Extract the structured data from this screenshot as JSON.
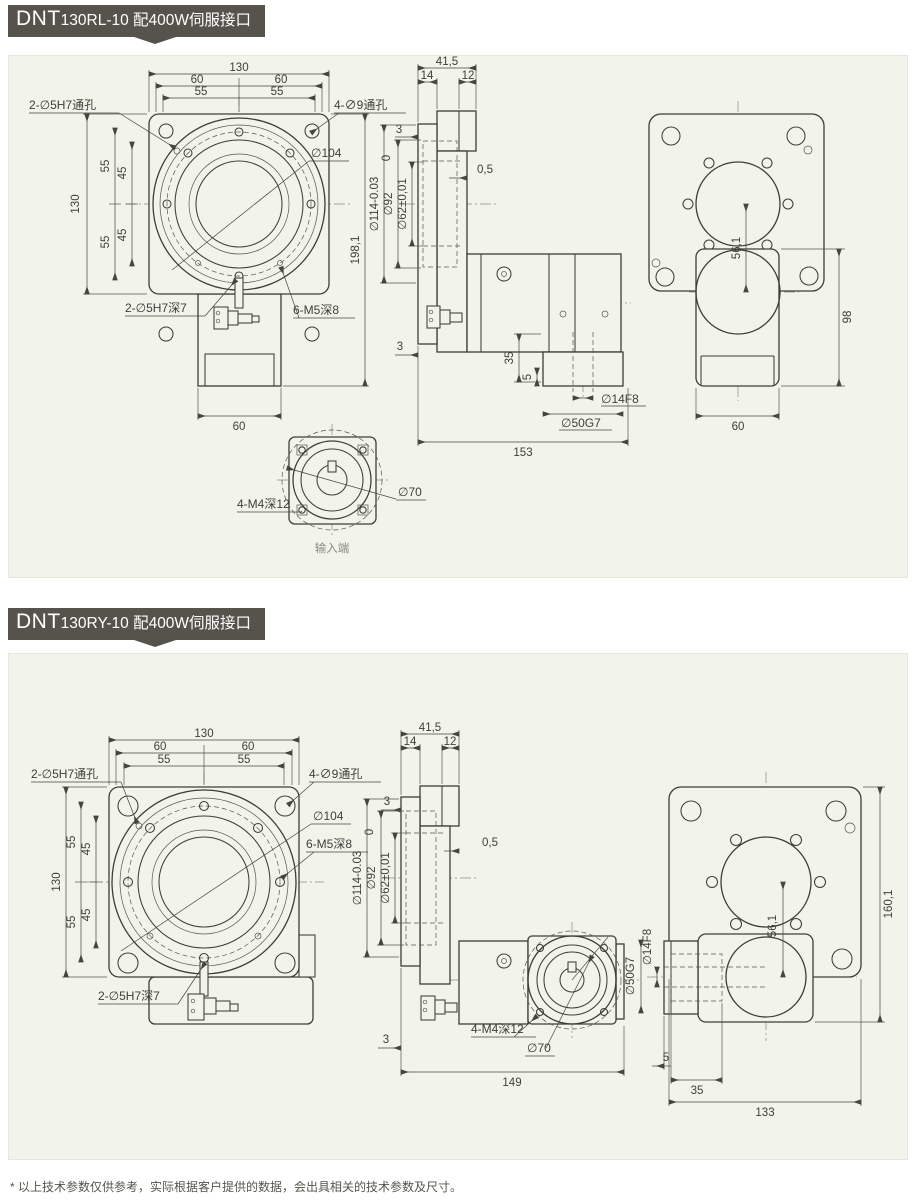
{
  "page": {
    "footer_note": "* 以上技术参数仅供参考，实际根据客户提供的数据，会出具相关的技术参数及尺寸。"
  },
  "p1": {
    "title": {
      "brand": "DNT",
      "rest": "130RL-10 配400W伺服接口"
    },
    "front": {
      "w": "130",
      "w60a": "60",
      "w60b": "60",
      "w55a": "55",
      "w55b": "55",
      "h": "130",
      "h55a": "55",
      "h45a": "45",
      "h45b": "45",
      "h55b": "55",
      "total_h": "198,1",
      "motor_w": "60",
      "lbl_pin_through": "2-∅5H7通孔",
      "lbl_through": "4-∅9通孔",
      "lbl_d104": "∅104",
      "lbl_pin_deep": "2-∅5H7深7",
      "lbl_m5": "6-M5深8"
    },
    "side": {
      "w": "41,5",
      "w14": "14",
      "w12": "12",
      "g3a": "3",
      "g05": "0,5",
      "g3b": "3",
      "tol0": "0",
      "d114": "∅114-0.03",
      "d92": "∅92",
      "d62": "∅62±0,01",
      "l35": "35",
      "l5": "5",
      "d14": "∅14F8",
      "d50": "∅50G7",
      "total": "153"
    },
    "rear": {
      "h98": "98",
      "w60": "60",
      "c561": "56,1"
    },
    "input": {
      "lbl_m4": "4-M4深12",
      "d70": "∅70",
      "caption": "输入端"
    }
  },
  "p2": {
    "title": {
      "brand": "DNT",
      "rest": "130RY-10 配400W伺服接口"
    },
    "front": {
      "w": "130",
      "w60a": "60",
      "w60b": "60",
      "w55a": "55",
      "w55b": "55",
      "h": "130",
      "h55a": "55",
      "h45a": "45",
      "h45b": "45",
      "h55b": "55",
      "lbl_pin_through": "2-∅5H7通孔",
      "lbl_through": "4-∅9通孔",
      "lbl_d104": "∅104",
      "lbl_pin_deep": "2-∅5H7深7",
      "lbl_m5": "6-M5深8"
    },
    "side": {
      "w": "41,5",
      "w14": "14",
      "w12": "12",
      "g3a": "3",
      "g05": "0,5",
      "g3b": "3",
      "tol0": "0",
      "d114": "∅114-0.03",
      "d92": "∅92",
      "d62": "∅62±0,01",
      "lbl_m4": "4-M4深12",
      "d70": "∅70",
      "total": "149"
    },
    "rear": {
      "h": "160,1",
      "c561": "56,1",
      "l5": "5",
      "l35": "35",
      "w": "133",
      "d14": "∅14F8",
      "d50": "∅50G7"
    }
  }
}
